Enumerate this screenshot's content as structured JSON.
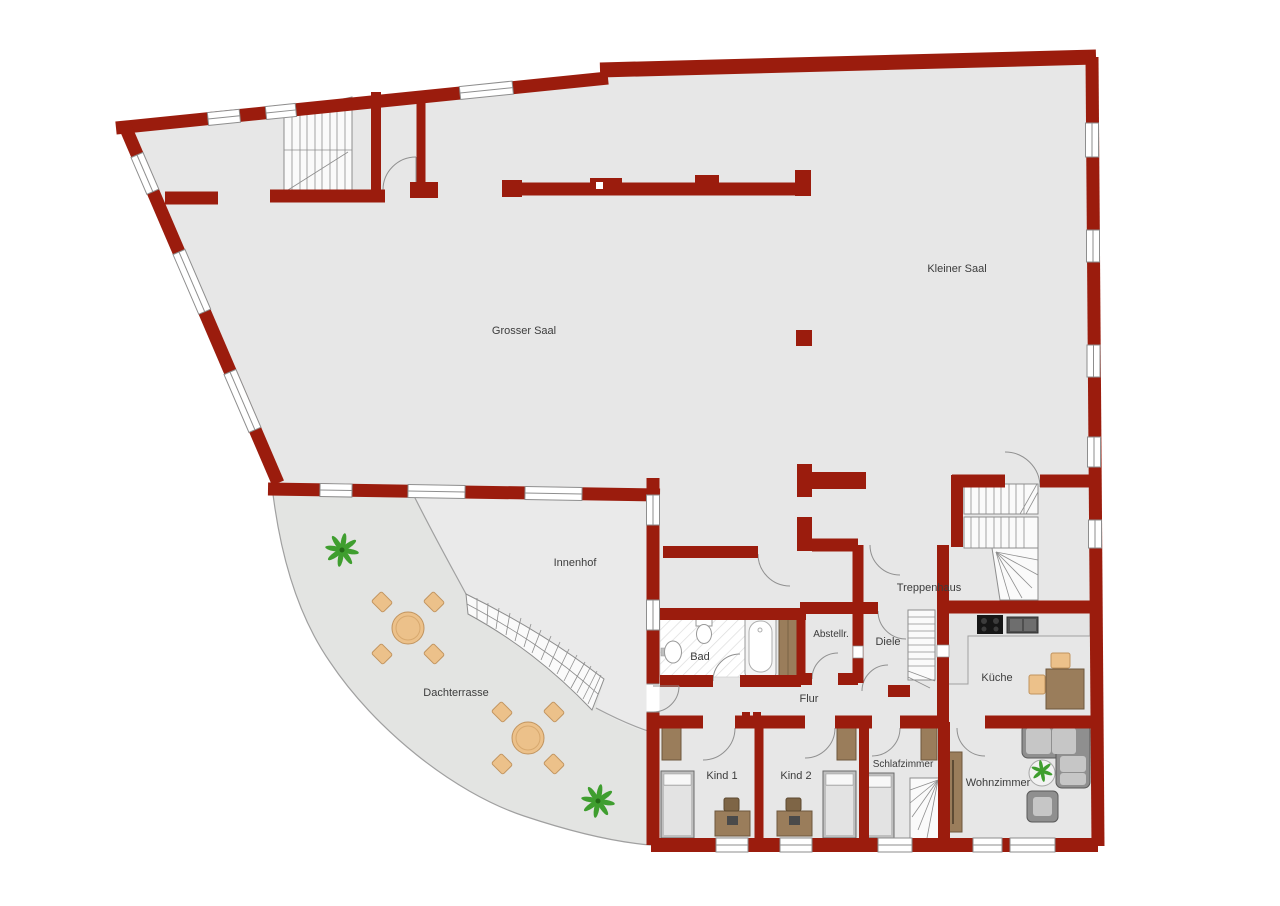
{
  "plan": {
    "rooms": {
      "grosser_saal": {
        "label": "Grosser Saal"
      },
      "kleiner_saal": {
        "label": "Kleiner Saal"
      },
      "innenhof": {
        "label": "Innenhof"
      },
      "dachterrasse": {
        "label": "Dachterrasse"
      },
      "treppenhaus": {
        "label": "Treppenhaus"
      },
      "bad": {
        "label": "Bad"
      },
      "abstellraum": {
        "label": "Abstellr."
      },
      "diele": {
        "label": "Diele"
      },
      "kueche": {
        "label": "Küche"
      },
      "flur": {
        "label": "Flur"
      },
      "kind_1": {
        "label": "Kind 1"
      },
      "kind_2": {
        "label": "Kind 2"
      },
      "schlafzimmer": {
        "label": "Schlafzimmer"
      },
      "wohnzimmer": {
        "label": "Wohnzimmer"
      }
    },
    "colors": {
      "wall": "#9b1c0d",
      "floor": "#e7e7e7",
      "terrace": "#e3e4e2",
      "wood": "#9a7d5b",
      "wood_light": "#ecc18a",
      "plant": "#3f9e2f"
    }
  }
}
